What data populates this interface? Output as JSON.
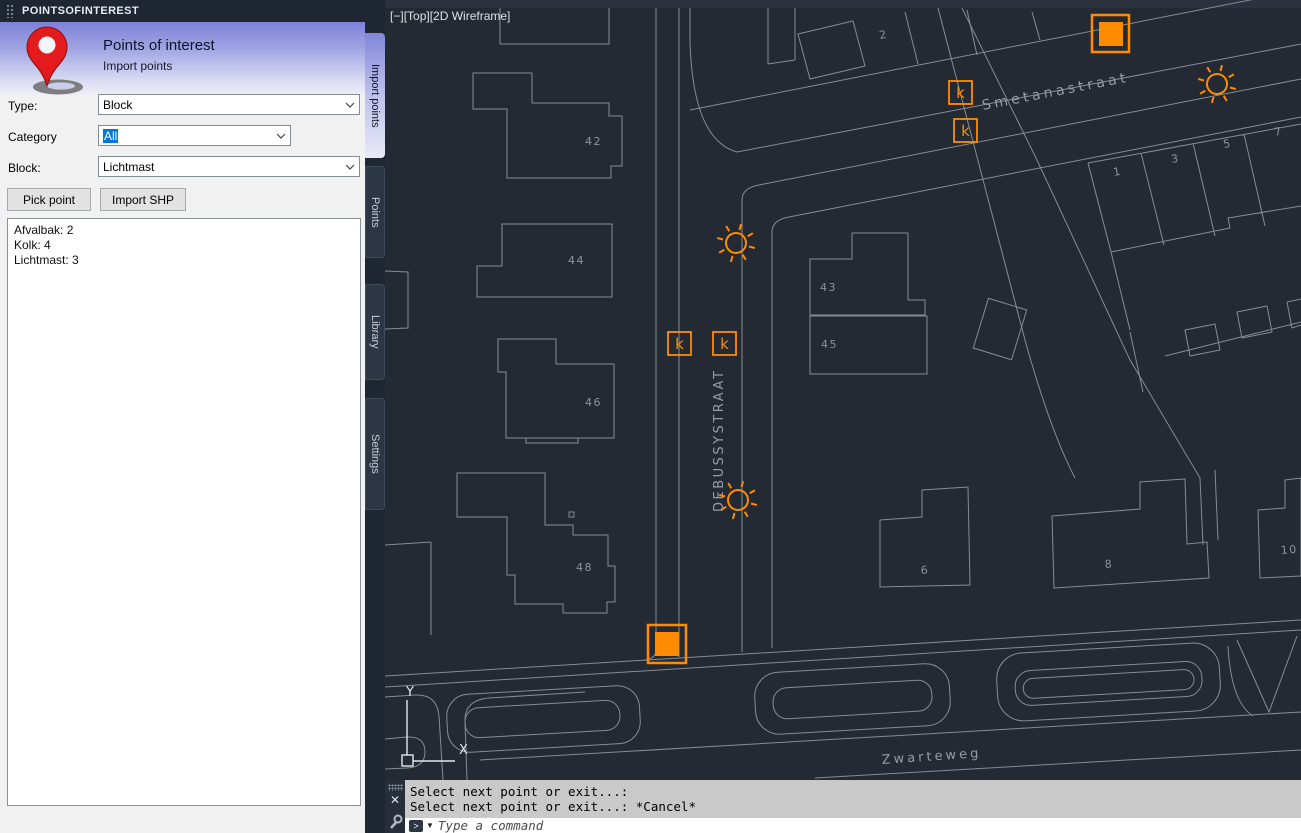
{
  "panel": {
    "titlebar": "POINTSOFINTEREST",
    "header": {
      "title": "Points of interest",
      "subtitle": "Import points"
    },
    "type_label": "Type:",
    "type_value": "Block",
    "category_label": "Category",
    "category_value": "All",
    "block_label": "Block:",
    "block_value": "Lichtmast",
    "pick_point": "Pick point",
    "import_shp": "Import SHP",
    "summary": {
      "line1": "Afvalbak: 2",
      "line2": "Kolk: 4",
      "line3": "Lichtmast: 3"
    },
    "tabs": {
      "t1": "Import points",
      "t2": "Points",
      "t3": "Library",
      "t4": "Settings"
    }
  },
  "viewport": {
    "controls": {
      "minimize": "[−]",
      "view": "[Top]",
      "visual_style": "[2D Wireframe]"
    },
    "streets": {
      "smetanastraat": "Smetanastraat",
      "debussystraat": "DEBUSSYSTRAAT",
      "zwarteweg": "Zwarteweg"
    },
    "buildings": {
      "n42": "42",
      "n44": "44",
      "n46": "46",
      "n48": "48",
      "n43": "43",
      "n45": "45",
      "n2": "2",
      "n1": "1",
      "n3": "3",
      "n5": "5",
      "n7": "7",
      "n6": "6",
      "n8": "8",
      "n10": "10"
    },
    "marker_glyphs": {
      "kolk": "k"
    },
    "ucs": {
      "x": "X",
      "y": "Y"
    }
  },
  "command": {
    "history_line1": "Select next point or exit...:",
    "history_line2": "Select next point or exit...: *Cancel*",
    "placeholder": "Type a command"
  },
  "icons": {
    "close": "✕",
    "prompt": ">"
  },
  "colors": {
    "marker_orange": "#FF8C00",
    "selection_blue": "#0078D7",
    "canvas_bg": "#242A34"
  }
}
